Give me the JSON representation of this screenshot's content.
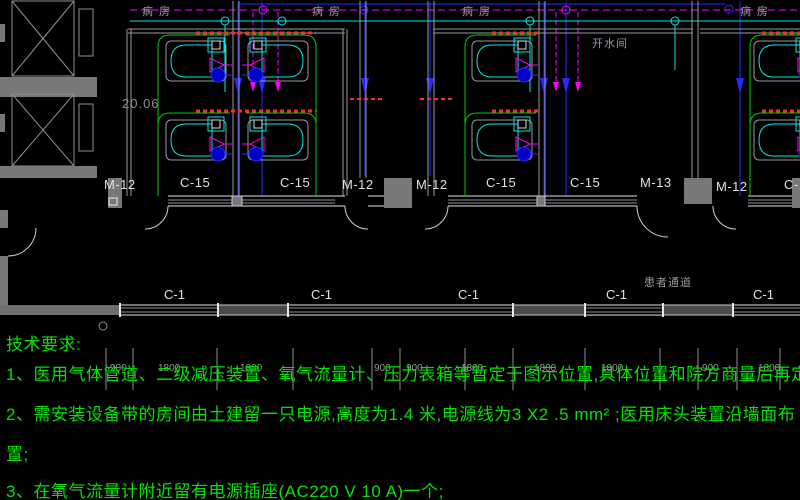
{
  "drawing": {
    "elevation_marker": "20.06",
    "ward_labels": [
      "病房",
      "病房",
      "病房",
      "病房"
    ],
    "utility_room_label": "开水间",
    "corridor_label": "患者通道",
    "opening_labels": [
      "M-12",
      "C-15",
      "C-15",
      "M-12",
      "M-12",
      "C-15",
      "C-15",
      "M-13",
      "M-12",
      "C-15"
    ],
    "corridor_window_labels": [
      "C-1",
      "C-1",
      "C-1",
      "C-1",
      "C-1"
    ],
    "dimension_values": [
      "900",
      "1800",
      "1800",
      "900",
      "900",
      "1800",
      "1800",
      "1800",
      "900",
      "1800"
    ]
  },
  "notes": {
    "title": "技术要求:",
    "line1": "1、医用气体管道、二级减压装置、氧气流量计、压力表箱等暂定于图示位置,具体位置和院方商量后再定",
    "line2": "2、需安装设备带的房间由土建留一只电源,高度为1.4 米,电源线为3 X2 .5 mm² ;医用床头装置沿墙面布",
    "line2_cont": "置;",
    "line3": "3、在氧气流量计附近留有电源插座(AC220 V 10 A)一个;"
  },
  "colors": {
    "background": "#000000",
    "pipe_cyan": "#00e8e8",
    "pipe_magenta": "#ff00ff",
    "pipe_blue": "#2929ff",
    "equipment_band_red": "#ff2a2a",
    "room_outline_green": "#00cc00",
    "wall_gray": "#8f8f8f",
    "notes_green": "#00e400",
    "label_white": "#e2e2e2",
    "label_gray": "#9a9a9a"
  }
}
